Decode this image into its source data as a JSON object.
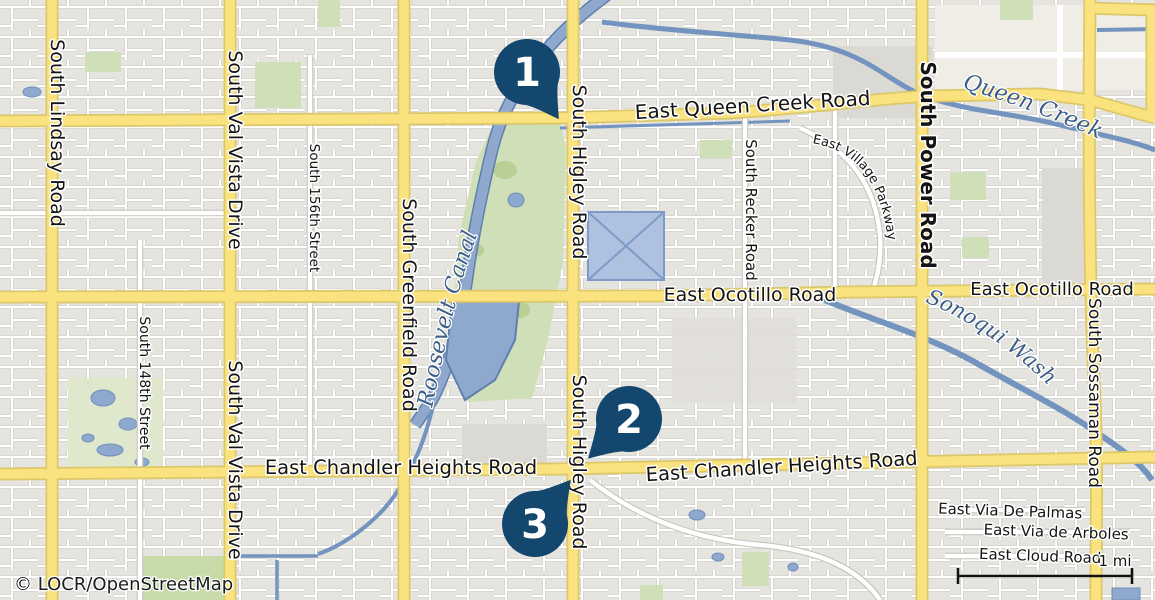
{
  "roads": {
    "lindsay": "South Lindsay Road",
    "val_vista": "South Val Vista Drive",
    "street_156": "South 156th Street",
    "greenfield": "South Greenfield Road",
    "higley": "South Higley Road",
    "recker": "South Recker Road",
    "power": "South Power Road",
    "sossaman": "South Sossaman Road",
    "street_148": "South 148th Street",
    "queen_creek_road": "East Queen Creek Road",
    "ocotillo": "East Ocotillo Road",
    "chandler_heights": "East Chandler Heights Road",
    "village_parkway": "East Village Parkway",
    "via_de_palmas": "East Via De Palmas",
    "via_de_arboles": "East Via de Arboles",
    "cloud_road": "East Cloud Road"
  },
  "waterways": {
    "queen_creek": "Queen Creek",
    "roosevelt_canal": "Roosevelt Canal",
    "sonoqui_wash": "Sonoqui Wash"
  },
  "markers": [
    {
      "number": "1"
    },
    {
      "number": "2"
    },
    {
      "number": "3"
    }
  ],
  "attribution": "© LOCR/OpenStreetMap",
  "scale_bar": {
    "label": "1 mi"
  },
  "colors": {
    "marker": "#14476D",
    "major_road_fill": "#FAE37E",
    "major_road_casing": "#DCC86A",
    "water_fill": "#8FA9CE",
    "water_line": "#7394BE",
    "park_green": "#CFE0B8",
    "background": "#F0EEE7",
    "residential": "#E6E4DE"
  }
}
